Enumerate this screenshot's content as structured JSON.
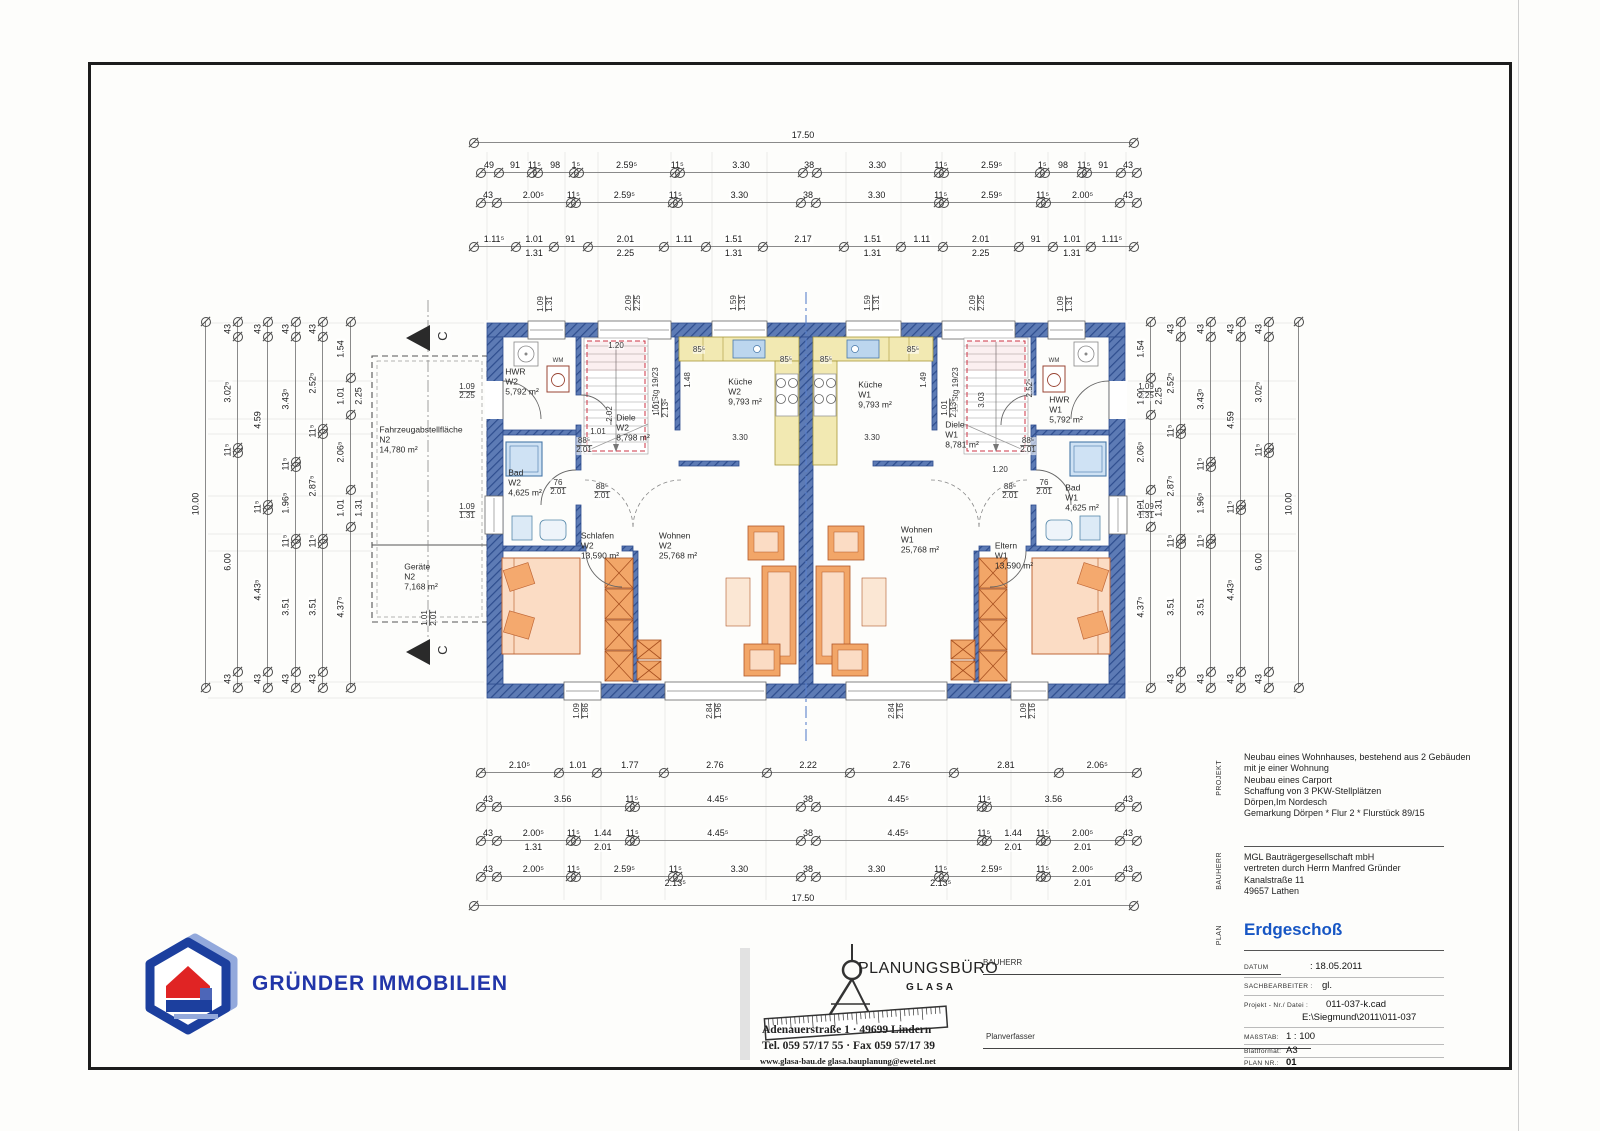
{
  "logo": {
    "text": "GRÜNDER IMMOBILIEN"
  },
  "stamp": {
    "name": "PLANUNGSBÜRO",
    "sub": "GLASA",
    "address": "Adenauerstraße 1  ·  49699 Lindern",
    "phone": "Tel. 059 57/17 55  ·  Fax 059 57/17 39",
    "web": "www.glasa-bau.de    glasa.bauplanung@ewetel.net",
    "bauherr_label": "BAUHERR",
    "planverfasser_label": "Planverfasser"
  },
  "titleblock": {
    "projekt_label": "PROJEKT",
    "bauherr_label": "BAUHERR",
    "plan_label": "PLAN",
    "projekt_lines": "Neubau eines Wohnhauses, bestehend aus 2 Gebäuden\nmit je einer Wohnung\nNeubau eines Carport\nSchaffung von 3 PKW-Stellplätzen\nDörpen,Im Nordesch\nGemarkung Dörpen * Flur 2 * Flurstück 89/15",
    "bauherr_lines": "MGL Bauträgergesellschaft mbH\nvertreten durch Herrn Manfred Gründer\nKanalstraße 11\n49657 Lathen",
    "plan_title": "Erdgeschoß",
    "rows": {
      "datum_label": "DATUM",
      "datum": ": 18.05.2011",
      "sach_label": "SACHBEARBEITER :",
      "sach": "gl.",
      "proj_label": "Projekt - Nr./ Datei :",
      "proj": "011-037-k.cad",
      "proj2": "E:\\Siegmund\\2011\\011-037",
      "mass_label": "MAßSTAB:",
      "mass": "1 : 100",
      "blatt_label": "Blattformat:",
      "blatt": "A3",
      "plannr_label": "PLAN NR.:",
      "plannr": "01"
    }
  },
  "rooms": [
    {
      "n": "HWR",
      "u": "W2",
      "a": "5,792 m²",
      "x": 522,
      "y": 382
    },
    {
      "n": "Bad",
      "u": "W2",
      "a": "4,625 m²",
      "x": 525,
      "y": 483
    },
    {
      "n": "Diele",
      "u": "W2",
      "a": "8,798 m²",
      "x": 633,
      "y": 428
    },
    {
      "n": "Küche",
      "u": "W2",
      "a": "9,793 m²",
      "x": 745,
      "y": 392
    },
    {
      "n": "Schlafen",
      "u": "W2",
      "a": "13,590 m²",
      "x": 600,
      "y": 546
    },
    {
      "n": "Wohnen",
      "u": "W2",
      "a": "25,768 m²",
      "x": 678,
      "y": 546
    },
    {
      "n": "Küche",
      "u": "W1",
      "a": "9,793 m²",
      "x": 875,
      "y": 395
    },
    {
      "n": "Diele",
      "u": "W1",
      "a": "8,781 m²",
      "x": 962,
      "y": 435
    },
    {
      "n": "HWR",
      "u": "W1",
      "a": "5,792 m²",
      "x": 1066,
      "y": 410
    },
    {
      "n": "Bad",
      "u": "W1",
      "a": "4,625 m²",
      "x": 1082,
      "y": 498
    },
    {
      "n": "Wohnen",
      "u": "W1",
      "a": "25,768 m²",
      "x": 920,
      "y": 540
    },
    {
      "n": "Eltern",
      "u": "W1",
      "a": "13,590 m²",
      "x": 1014,
      "y": 556
    },
    {
      "n": "Fahrzeugabstellfläche",
      "u": "N2",
      "a": "14,780 m²",
      "x": 421,
      "y": 440
    },
    {
      "n": "Geräte",
      "u": "N2",
      "a": "7,168 m²",
      "x": 421,
      "y": 577
    }
  ],
  "labels": [
    {
      "t": "1.09",
      "x": 546,
      "y": 304,
      "r": 1,
      "b": "1.31"
    },
    {
      "t": "2.09",
      "x": 634,
      "y": 303,
      "r": 1,
      "b": "2.25"
    },
    {
      "t": "1.59",
      "x": 739,
      "y": 303,
      "r": 1,
      "b": "1.31"
    },
    {
      "t": "1.59",
      "x": 873,
      "y": 303,
      "r": 1,
      "b": "1.31"
    },
    {
      "t": "2.09",
      "x": 978,
      "y": 303,
      "r": 1,
      "b": "2.25"
    },
    {
      "t": "1.09",
      "x": 1066,
      "y": 304,
      "r": 1,
      "b": "1.31"
    },
    {
      "t": "1.09",
      "x": 582,
      "y": 711,
      "r": 1,
      "b": "1.86"
    },
    {
      "t": "2.84",
      "x": 715,
      "y": 711,
      "r": 1,
      "b": "1.96"
    },
    {
      "t": "2.84",
      "x": 897,
      "y": 711,
      "r": 1,
      "b": "2.16"
    },
    {
      "t": "1.09",
      "x": 1029,
      "y": 711,
      "r": 1,
      "b": "2.16"
    },
    {
      "t": "1.09",
      "x": 467,
      "y": 392,
      "b": "2.25"
    },
    {
      "t": "1.09",
      "x": 467,
      "y": 512,
      "b": "1.31"
    },
    {
      "t": "1.09",
      "x": 1146,
      "y": 392,
      "b": "2.25"
    },
    {
      "t": "1.09",
      "x": 1146,
      "y": 512,
      "b": "1.31"
    },
    {
      "t": "1.01",
      "x": 430,
      "y": 618,
      "r": 1,
      "b": "2.01"
    },
    {
      "t": "1.20",
      "x": 616,
      "y": 346
    },
    {
      "t": "15 Stg 19/23",
      "x": 656,
      "y": 390,
      "r": 1
    },
    {
      "t": "2.02",
      "x": 610,
      "y": 414,
      "r": 1
    },
    {
      "t": "1.01",
      "x": 598,
      "y": 432
    },
    {
      "t": "85⁵",
      "x": 699,
      "y": 350
    },
    {
      "t": "85⁵",
      "x": 786,
      "y": 360
    },
    {
      "t": "1.48",
      "x": 688,
      "y": 380,
      "r": 1
    },
    {
      "t": "1.01",
      "x": 662,
      "y": 408,
      "r": 1,
      "b": "2.13⁵"
    },
    {
      "t": "3.30",
      "x": 740,
      "y": 438
    },
    {
      "t": "88⁵",
      "x": 584,
      "y": 446,
      "b": "2.01"
    },
    {
      "t": "76",
      "x": 558,
      "y": 488,
      "b": "2.01"
    },
    {
      "t": "88⁵",
      "x": 602,
      "y": 492,
      "b": "2.01"
    },
    {
      "t": "1.20",
      "x": 1000,
      "y": 470
    },
    {
      "t": "15 Stg 19/23",
      "x": 956,
      "y": 390,
      "r": 1
    },
    {
      "t": "2.52⁵",
      "x": 1030,
      "y": 388,
      "r": 1
    },
    {
      "t": "3.03",
      "x": 982,
      "y": 400,
      "r": 1
    },
    {
      "t": "85⁵",
      "x": 826,
      "y": 360
    },
    {
      "t": "85⁵",
      "x": 913,
      "y": 350
    },
    {
      "t": "1.49",
      "x": 924,
      "y": 380,
      "r": 1
    },
    {
      "t": "1.01",
      "x": 950,
      "y": 408,
      "r": 1,
      "b": "2.13⁵"
    },
    {
      "t": "3.30",
      "x": 872,
      "y": 438
    },
    {
      "t": "88⁵",
      "x": 1028,
      "y": 446,
      "b": "2.01"
    },
    {
      "t": "76",
      "x": 1044,
      "y": 488,
      "b": "2.01"
    },
    {
      "t": "88⁵",
      "x": 1010,
      "y": 492,
      "b": "2.01"
    },
    {
      "t": "WM",
      "x": 558,
      "y": 361,
      "s": 6
    },
    {
      "t": "WM",
      "x": 1054,
      "y": 361,
      "s": 6
    },
    {
      "t": "C",
      "x": 443,
      "y": 336,
      "r": 1,
      "s": 13
    },
    {
      "t": "C",
      "x": 443,
      "y": 650,
      "r": 1,
      "s": 13
    }
  ],
  "dims": {
    "chains": [
      {
        "o": "h",
        "p": 142,
        "a": 473,
        "b": 1133,
        "t": [
          "17.50"
        ]
      },
      {
        "o": "h",
        "p": 172,
        "a": 480,
        "b": 1136,
        "t": [
          "49",
          "91",
          "11⁵",
          "98",
          "1⁵",
          "2.59⁵",
          "11⁵",
          "3.30",
          "38",
          "3.30",
          "11⁵",
          "2.59⁵",
          "1⁵",
          "98",
          "11⁵",
          "91",
          "43"
        ]
      },
      {
        "o": "h",
        "p": 202,
        "a": 480,
        "b": 1136,
        "t": [
          "43",
          "2.00⁵",
          "11⁵",
          "2.59⁵",
          "11⁵",
          "3.30",
          "38",
          "3.30",
          "11⁵",
          "2.59⁵",
          "11⁵",
          "2.00⁵",
          "43"
        ]
      },
      {
        "o": "h",
        "p": 246,
        "a": 473,
        "b": 1133,
        "t": [
          {
            "t": "1.11⁵"
          },
          {
            "t": "1.01",
            "b": "1.31"
          },
          {
            "t": "91"
          },
          {
            "t": "2.01",
            "b": "2.25"
          },
          {
            "t": "1.11"
          },
          {
            "t": "1.51",
            "b": "1.31"
          },
          {
            "t": "2.17"
          },
          {
            "t": "1.51",
            "b": "1.31"
          },
          {
            "t": "1.11"
          },
          {
            "t": "2.01",
            "b": "2.25"
          },
          {
            "t": "91"
          },
          {
            "t": "1.01",
            "b": "1.31"
          },
          {
            "t": "1.11⁵"
          }
        ]
      },
      {
        "o": "h",
        "p": 772,
        "a": 480,
        "b": 1136,
        "t": [
          "2.10⁵",
          "1.01",
          "1.77",
          "2.76",
          "2.22",
          "2.76",
          "2.81",
          "2.06⁵"
        ]
      },
      {
        "o": "h",
        "p": 806,
        "a": 480,
        "b": 1136,
        "t": [
          "43",
          "3.56",
          "11⁵",
          "4.45⁵",
          "38",
          "4.45⁵",
          "11⁵",
          "3.56",
          "43"
        ]
      },
      {
        "o": "h",
        "p": 840,
        "a": 480,
        "b": 1136,
        "t": [
          {
            "t": "43"
          },
          {
            "t": "2.00⁵",
            "b": "1.31"
          },
          {
            "t": "11⁵"
          },
          {
            "t": "1.44",
            "b": "2.01"
          },
          {
            "t": "11⁵"
          },
          {
            "t": "4.45⁵"
          },
          {
            "t": "38"
          },
          {
            "t": "4.45⁵"
          },
          {
            "t": "11⁵"
          },
          {
            "t": "1.44",
            "b": "2.01"
          },
          {
            "t": "11⁵"
          },
          {
            "t": "2.00⁵",
            "b": "2.01"
          },
          {
            "t": "43"
          }
        ]
      },
      {
        "o": "h",
        "p": 876,
        "a": 480,
        "b": 1136,
        "t": [
          {
            "t": "43"
          },
          {
            "t": "2.00⁵"
          },
          {
            "t": "11⁵"
          },
          {
            "t": "2.59⁵"
          },
          {
            "t": "11⁵",
            "b": "2.13⁵"
          },
          {
            "t": "3.30"
          },
          {
            "t": "38"
          },
          {
            "t": "3.30"
          },
          {
            "t": "11⁵",
            "b": "2.13⁵"
          },
          {
            "t": "2.59⁵"
          },
          {
            "t": "11⁵"
          },
          {
            "t": "2.00⁵",
            "b": "2.01"
          },
          {
            "t": "43"
          }
        ]
      },
      {
        "o": "h",
        "p": 905,
        "a": 473,
        "b": 1133,
        "t": [
          "17.50"
        ]
      },
      {
        "o": "v",
        "p": 205,
        "a": 321,
        "b": 687,
        "t": [
          "10.00"
        ]
      },
      {
        "o": "v",
        "p": 237,
        "a": 321,
        "b": 687,
        "t": [
          "43",
          "3.02⁵",
          "11⁵",
          "6.00",
          "43"
        ]
      },
      {
        "o": "v",
        "p": 267,
        "a": 321,
        "b": 687,
        "t": [
          "43",
          "4.59",
          "11⁵",
          "4.43⁵",
          "43"
        ]
      },
      {
        "o": "v",
        "p": 295,
        "a": 321,
        "b": 687,
        "t": [
          "43",
          "3.43⁵",
          "11⁵",
          "1.96⁵",
          "11⁵",
          "3.51",
          "43"
        ]
      },
      {
        "o": "v",
        "p": 322,
        "a": 321,
        "b": 687,
        "t": [
          "43",
          "2.52⁵",
          "11⁵",
          "2.87⁵",
          "11⁵",
          "3.51",
          "43"
        ]
      },
      {
        "o": "v",
        "p": 350,
        "a": 321,
        "b": 687,
        "t": [
          {
            "t": "1.54"
          },
          {
            "t": "1.01",
            "b": "2.25"
          },
          {
            "t": "2.06⁵"
          },
          {
            "t": "1.01",
            "b": "1.31"
          },
          {
            "t": "4.37⁵"
          }
        ]
      },
      {
        "o": "v",
        "p": 1150,
        "a": 321,
        "b": 687,
        "t": [
          {
            "t": "1.54"
          },
          {
            "t": "1.01",
            "b": "2.25"
          },
          {
            "t": "2.06⁵"
          },
          {
            "t": "1.01",
            "b": "1.31"
          },
          {
            "t": "4.37⁵"
          }
        ]
      },
      {
        "o": "v",
        "p": 1180,
        "a": 321,
        "b": 687,
        "t": [
          "43",
          "2.52⁵",
          "11⁵",
          "2.87⁵",
          "11⁵",
          "3.51",
          "43"
        ]
      },
      {
        "o": "v",
        "p": 1210,
        "a": 321,
        "b": 687,
        "t": [
          "43",
          "3.43⁵",
          "11⁵",
          "1.96⁵",
          "11⁵",
          "3.51",
          "43"
        ]
      },
      {
        "o": "v",
        "p": 1240,
        "a": 321,
        "b": 687,
        "t": [
          "43",
          "4.59",
          "11⁵",
          "4.43⁵",
          "43"
        ]
      },
      {
        "o": "v",
        "p": 1268,
        "a": 321,
        "b": 687,
        "t": [
          "43",
          "3.02⁵",
          "11⁵",
          "6.00",
          "43"
        ]
      },
      {
        "o": "v",
        "p": 1298,
        "a": 321,
        "b": 687,
        "t": [
          "10.00"
        ]
      }
    ]
  }
}
